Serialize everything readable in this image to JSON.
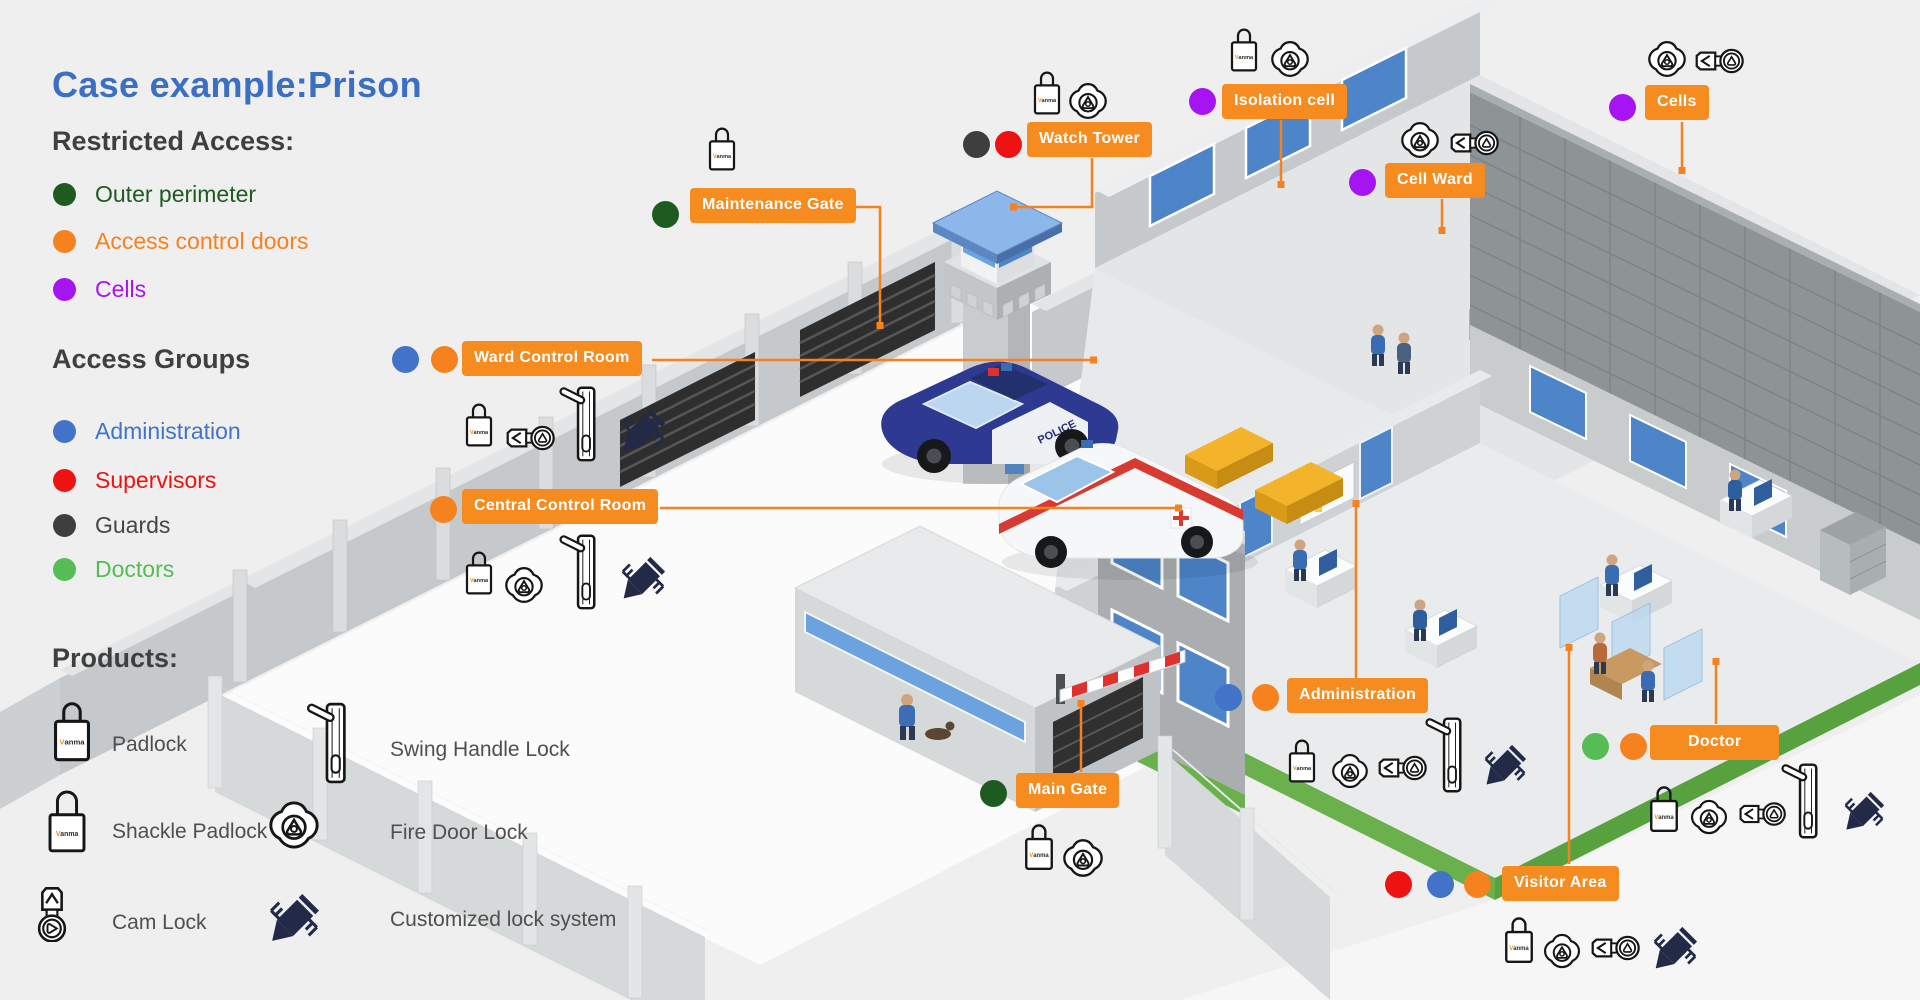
{
  "title": "Case example:Prison",
  "brand": {
    "v": "V",
    "rest": "anma",
    "full": "Vanma"
  },
  "scene": {
    "police_car_text": "POLICE"
  },
  "colors": {
    "background": "#efefef",
    "title_blue": "#3a6fc4",
    "callout_orange": "#f68b1f",
    "outer_perimeter": "#1e5b20",
    "access_control_doors": "#f5821f",
    "cells": "#a714f2",
    "administration": "#4273c8",
    "supervisors": "#ee1212",
    "guards": "#3e3e3e",
    "doctors": "#54bd54"
  },
  "legend": {
    "restricted_access": {
      "heading": "Restricted Access:",
      "items": [
        {
          "label": "Outer perimeter",
          "color": "#1e5b20"
        },
        {
          "label": "Access control doors",
          "color": "#f5821f"
        },
        {
          "label": "Cells",
          "color": "#a714f2"
        }
      ]
    },
    "access_groups": {
      "heading": "Access Groups",
      "items": [
        {
          "label": "Administration",
          "color": "#4273c8"
        },
        {
          "label": "Supervisors",
          "color": "#ee1212"
        },
        {
          "label": "Guards",
          "color": "#3e3e3e"
        },
        {
          "label": "Doctors",
          "color": "#54bd54"
        }
      ]
    },
    "products": {
      "heading": "Products:",
      "items": [
        {
          "label": "Padlock",
          "icon": "padlock"
        },
        {
          "label": "Swing Handle Lock",
          "icon": "swing-handle-lock"
        },
        {
          "label": "Shackle Padlock",
          "icon": "shackle-padlock"
        },
        {
          "label": "Fire Door Lock",
          "icon": "fire-door-lock"
        },
        {
          "label": "Cam Lock",
          "icon": "cam-lock"
        },
        {
          "label": "Customized lock system",
          "icon": "customized-lock-system"
        }
      ]
    }
  },
  "callouts": [
    {
      "label": "Maintenance Gate",
      "restricted_access": [
        "Outer perimeter"
      ],
      "access_groups": [],
      "products": [
        "Padlock"
      ]
    },
    {
      "label": "Watch Tower",
      "restricted_access": [],
      "access_groups": [
        "Guards",
        "Supervisors"
      ],
      "products": [
        "Padlock",
        "Fire Door Lock"
      ]
    },
    {
      "label": "Isolation cell",
      "restricted_access": [
        "Cells"
      ],
      "access_groups": [],
      "products": [
        "Padlock",
        "Fire Door Lock"
      ]
    },
    {
      "label": "Cell Ward",
      "restricted_access": [
        "Cells"
      ],
      "access_groups": [],
      "products": [
        "Fire Door Lock",
        "Cam Lock"
      ]
    },
    {
      "label": "Cells",
      "restricted_access": [
        "Cells"
      ],
      "access_groups": [],
      "products": [
        "Fire Door Lock",
        "Cam Lock"
      ]
    },
    {
      "label": "Ward Control Room",
      "restricted_access": [
        "Access control doors"
      ],
      "access_groups": [
        "Administration"
      ],
      "products": [
        "Padlock",
        "Cam Lock",
        "Swing Handle Lock",
        "Customized lock system"
      ]
    },
    {
      "label": "Central Control Room",
      "restricted_access": [
        "Access control doors"
      ],
      "access_groups": [],
      "products": [
        "Padlock",
        "Fire Door Lock",
        "Swing Handle Lock",
        "Customized lock system"
      ]
    },
    {
      "label": "Administration",
      "restricted_access": [
        "Access control doors"
      ],
      "access_groups": [
        "Administration"
      ],
      "products": [
        "Padlock",
        "Fire Door Lock",
        "Cam Lock",
        "Swing Handle Lock",
        "Customized lock system"
      ]
    },
    {
      "label": "Main Gate",
      "restricted_access": [
        "Outer perimeter"
      ],
      "access_groups": [],
      "products": [
        "Padlock",
        "Fire Door Lock"
      ]
    },
    {
      "label": "Doctor",
      "restricted_access": [
        "Access control doors"
      ],
      "access_groups": [
        "Doctors"
      ],
      "products": [
        "Padlock",
        "Fire Door Lock",
        "Cam Lock",
        "Swing Handle Lock",
        "Customized lock system"
      ]
    },
    {
      "label": "Visitor Area",
      "restricted_access": [
        "Access control doors"
      ],
      "access_groups": [
        "Supervisors",
        "Administration"
      ],
      "products": [
        "Padlock",
        "Fire Door Lock",
        "Cam Lock",
        "Customized lock system"
      ]
    }
  ]
}
